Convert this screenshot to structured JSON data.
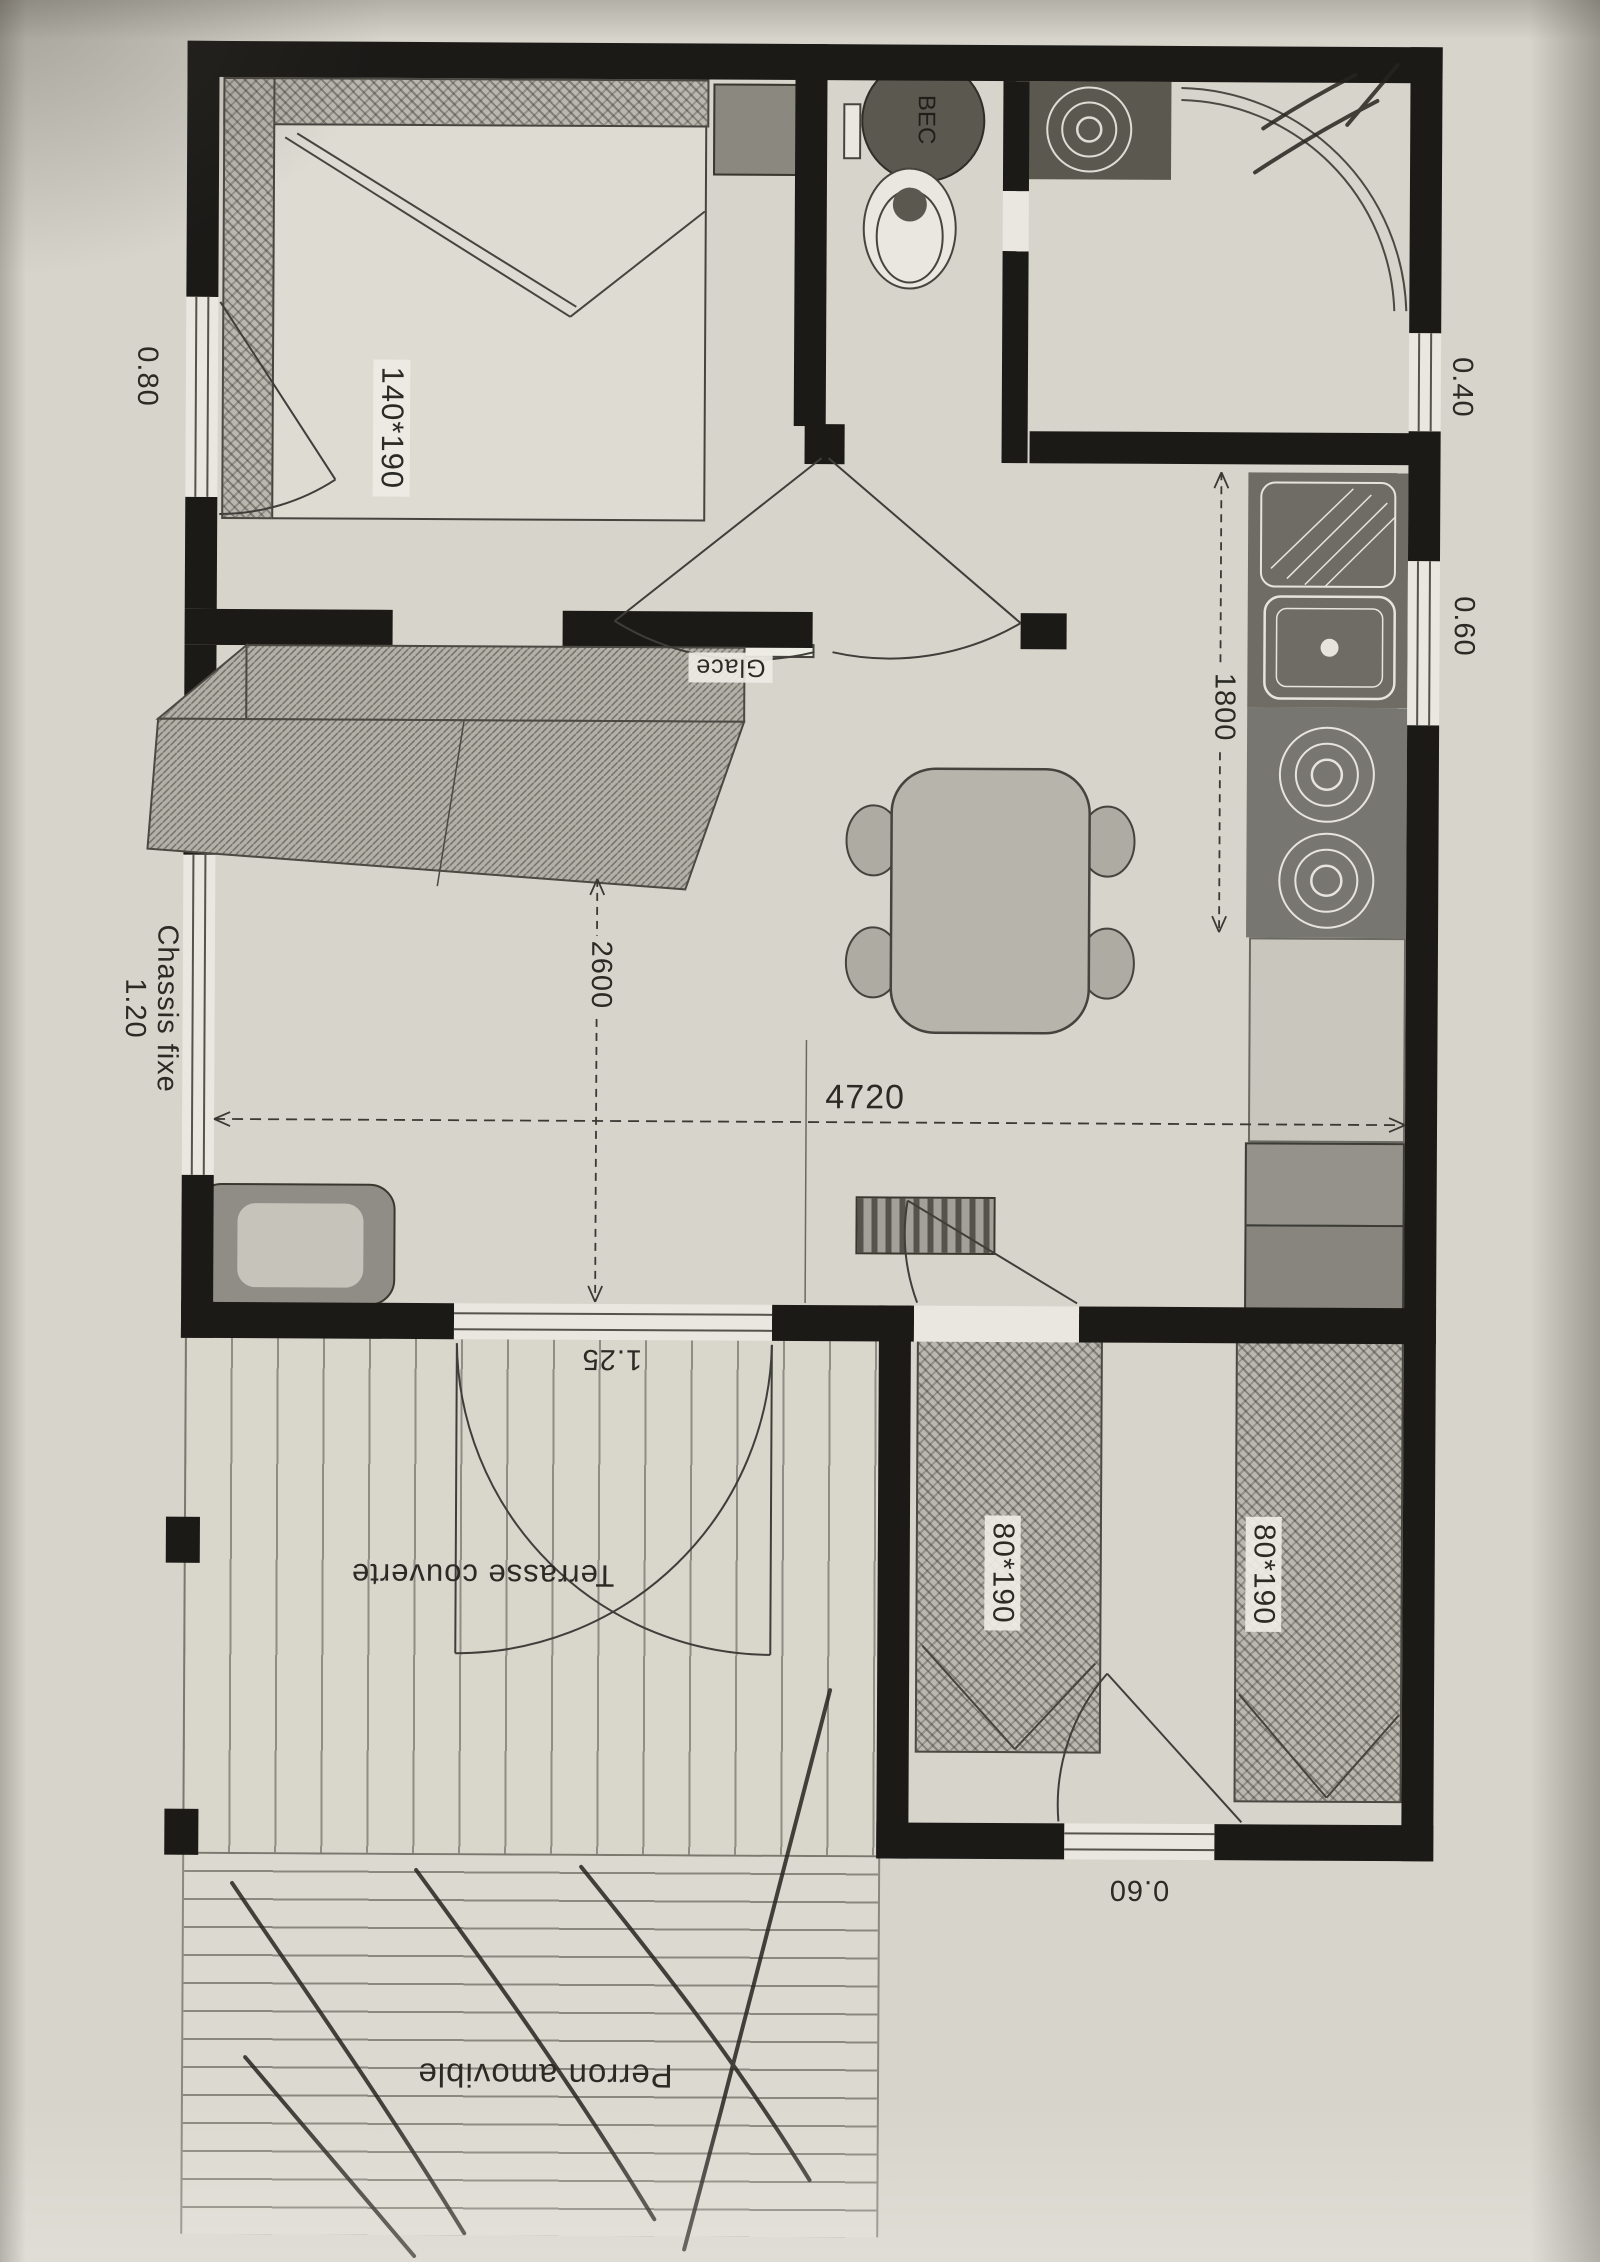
{
  "colors": {
    "paper": "#d7d4cb",
    "ink": "#2b2a25",
    "wall": "#1b1a17",
    "furniture_gray": "#b3b0a7",
    "dark_fixture": "#5b594f"
  },
  "labels": {
    "door_bedroom1_width": "0.80",
    "double_bed_size": "140*190",
    "water_heater": "BEC",
    "shower_window_width": "0.40",
    "kitchen_window_width": "0.60",
    "kitchen_counter_length": "1800",
    "mirror": "Glace",
    "living_room_depth": "2600",
    "overall_interior_width": "4720",
    "fixed_window_name": "Chassis fixe",
    "fixed_window_width": "1.20",
    "entrance_door_width": "1.25",
    "terrace_name": "Terrasse couverte",
    "single_bed_left_size": "80*190",
    "single_bed_right_size": "80*190",
    "bedroom2_window_width": "0.60",
    "steps_name": "Perron amovible"
  }
}
